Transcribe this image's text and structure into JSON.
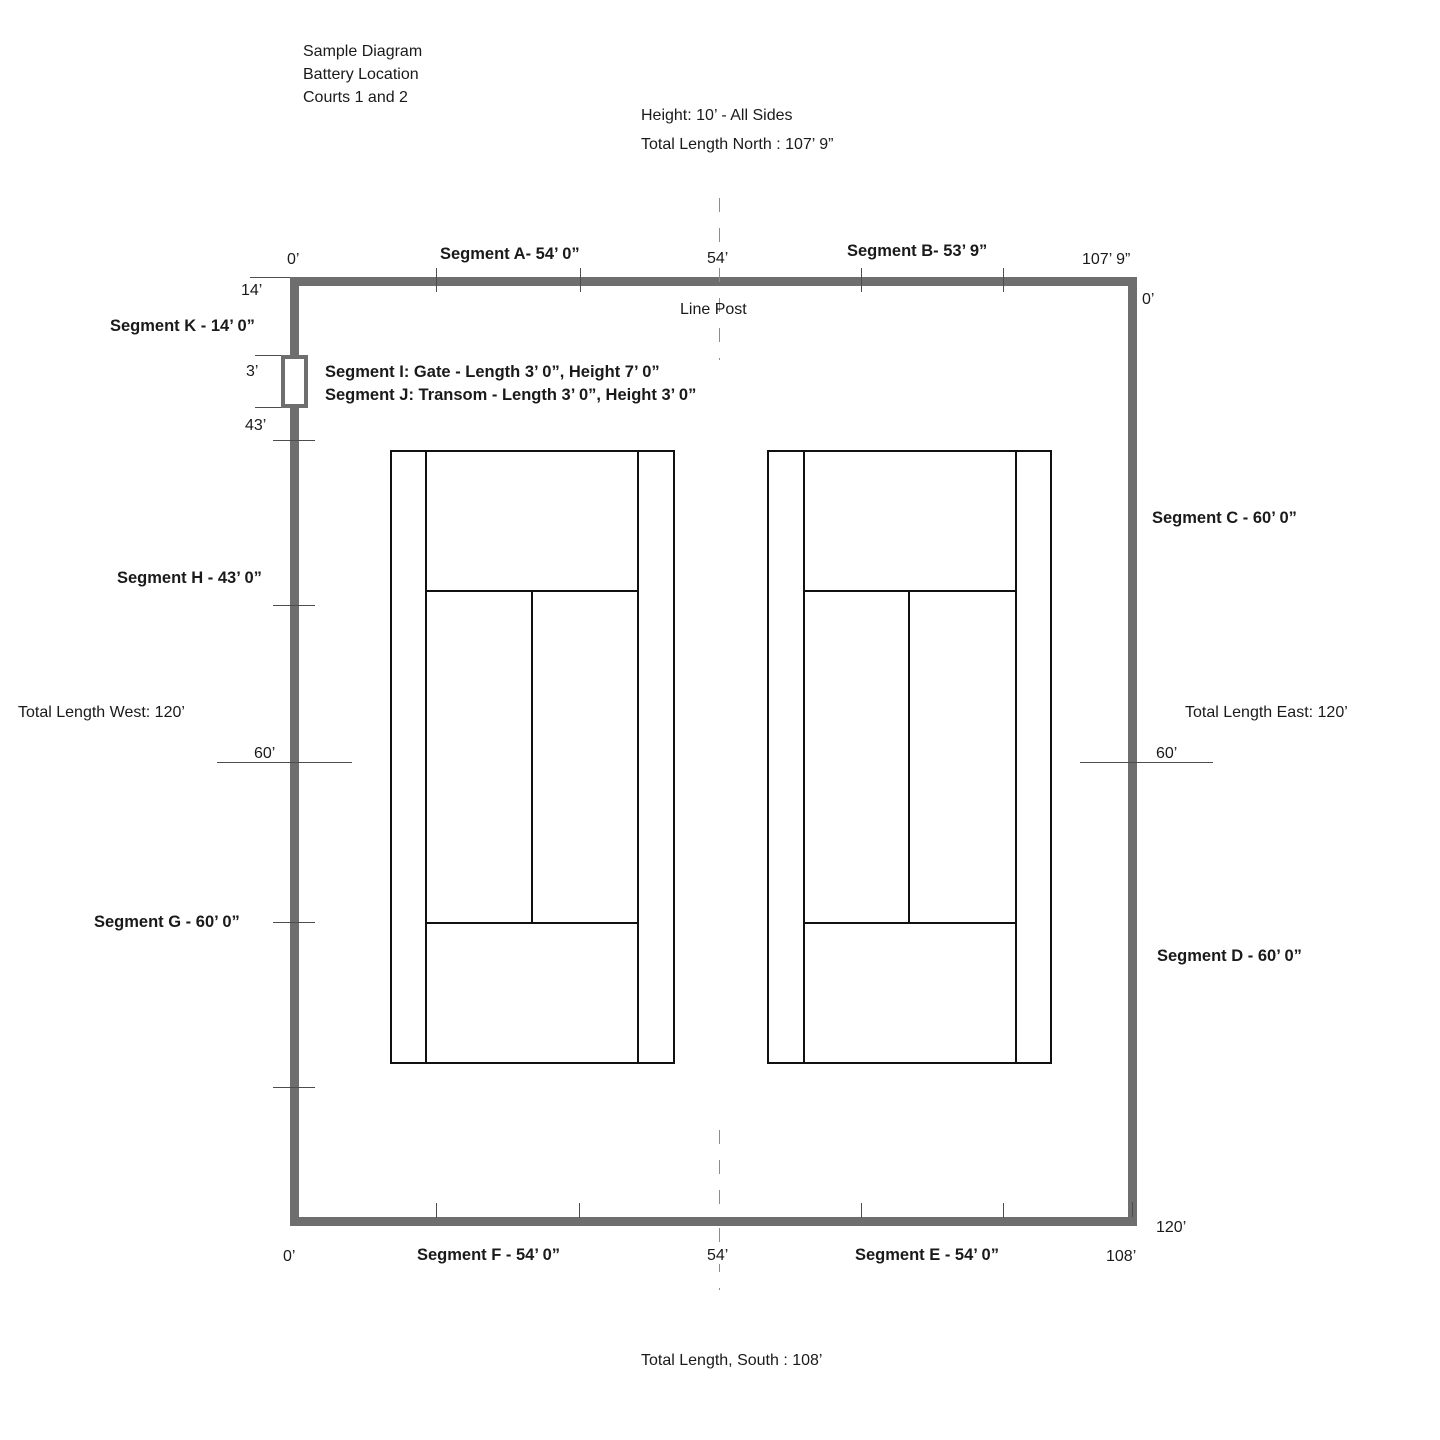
{
  "title_block": {
    "lines": [
      "Sample Diagram",
      "Battery Location",
      "Courts 1 and 2"
    ]
  },
  "north": {
    "height_note": "Height: 10’ - All Sides",
    "total": "Total Length North : 107’ 9”",
    "scale_start": "0’",
    "segment_a": "Segment A- 54’ 0”",
    "scale_mid": "54’",
    "segment_b": "Segment B- 53’ 9”",
    "scale_end": "107’ 9”",
    "corner_left": "14’",
    "corner_right": "0’",
    "line_post": "Line Post"
  },
  "west": {
    "segment_k": "Segment K - 14’ 0”",
    "gate_label": "Segment I: Gate - Length 3’ 0”, Height 7’ 0”",
    "transom_label": "Segment J: Transom - Length 3’ 0”, Height 3’ 0”",
    "tick_3": "3’",
    "tick_43": "43’",
    "segment_h": "Segment H - 43’ 0”",
    "total": "Total Length West: 120’",
    "tick_60": "60’",
    "segment_g": "Segment G - 60’ 0”"
  },
  "east": {
    "segment_c": "Segment C - 60’ 0”",
    "total": "Total Length East: 120’",
    "tick_60": "60’",
    "segment_d": "Segment D - 60’ 0”",
    "tick_120": "120’"
  },
  "south": {
    "scale_start": "0’",
    "segment_f": "Segment F - 54’ 0”",
    "scale_mid": "54’",
    "segment_e": "Segment E - 54’ 0”",
    "scale_end": "108’",
    "total": "Total Length, South : 108’"
  },
  "colors": {
    "fence": "#6e6e6e",
    "court_line": "#111111",
    "tick": "#4d4d4d",
    "dash": "#8c8c8c",
    "text": "#1a1a1a"
  }
}
